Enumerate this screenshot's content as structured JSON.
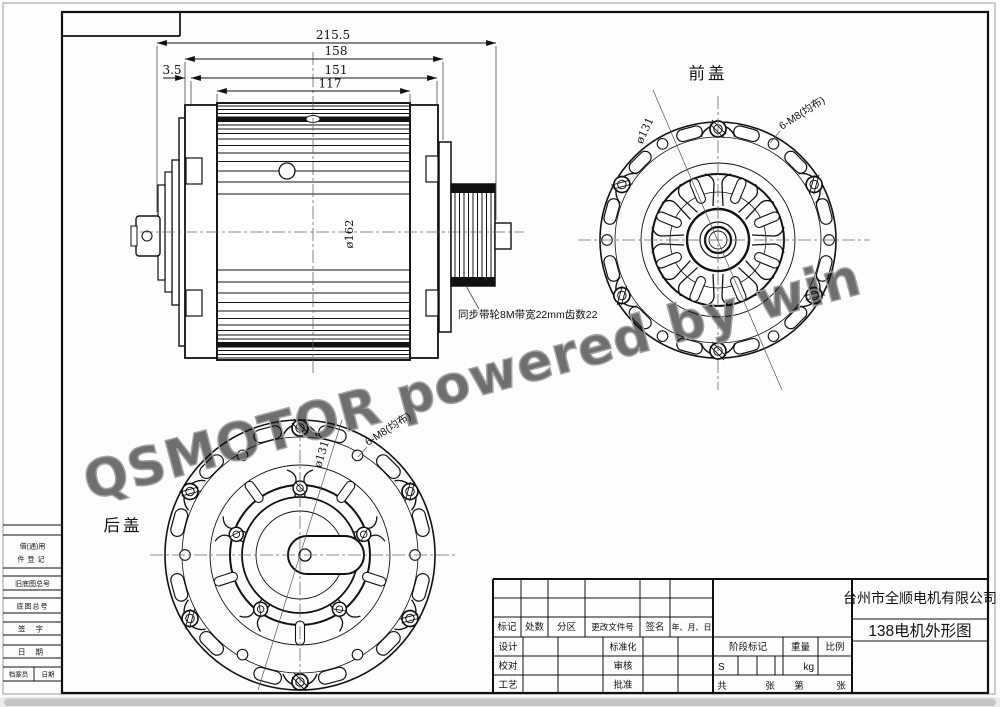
{
  "watermark": "QSMOTOR powered by win",
  "views": {
    "front_label": "前盖",
    "rear_label": "后盖",
    "pulley_note": "同步带轮8M带宽22mm齿数22"
  },
  "dimensions": {
    "overall": "215.5",
    "cap_span": "158",
    "inner_span": "151",
    "body_width": "117",
    "offset": "3.5",
    "body_diameter": "ø162",
    "bolt_circle": "ø131",
    "bolt_pattern": "6-M8(均布)"
  },
  "margin_labels": {
    "borrow_line1": "借(通)用",
    "borrow_line2": "件登记",
    "old_drawing_no": "旧底图总号",
    "drawing_no": "底图总号",
    "signature": "签 字",
    "date": "日 期",
    "archivist": "档案员",
    "archive_date": "日期"
  },
  "title_block": {
    "company": "台州市全顺电机有限公司",
    "drawing_title": "138电机外形图",
    "rev_headers": [
      "标记",
      "处数",
      "分区",
      "更改文件号",
      "签名",
      "年、月、日"
    ],
    "roles": {
      "design": "设计",
      "standardization": "标准化",
      "check": "校对",
      "audit": "审核",
      "process": "工艺",
      "approve": "批准"
    },
    "stage_mark": "阶段标记",
    "weight": "重量",
    "scale": "比例",
    "stage_value": "S",
    "weight_unit": "kg",
    "sheets_total_prefix": "共",
    "sheets_total_suffix": "张",
    "sheet_prefix": "第",
    "sheet_suffix": "张"
  }
}
